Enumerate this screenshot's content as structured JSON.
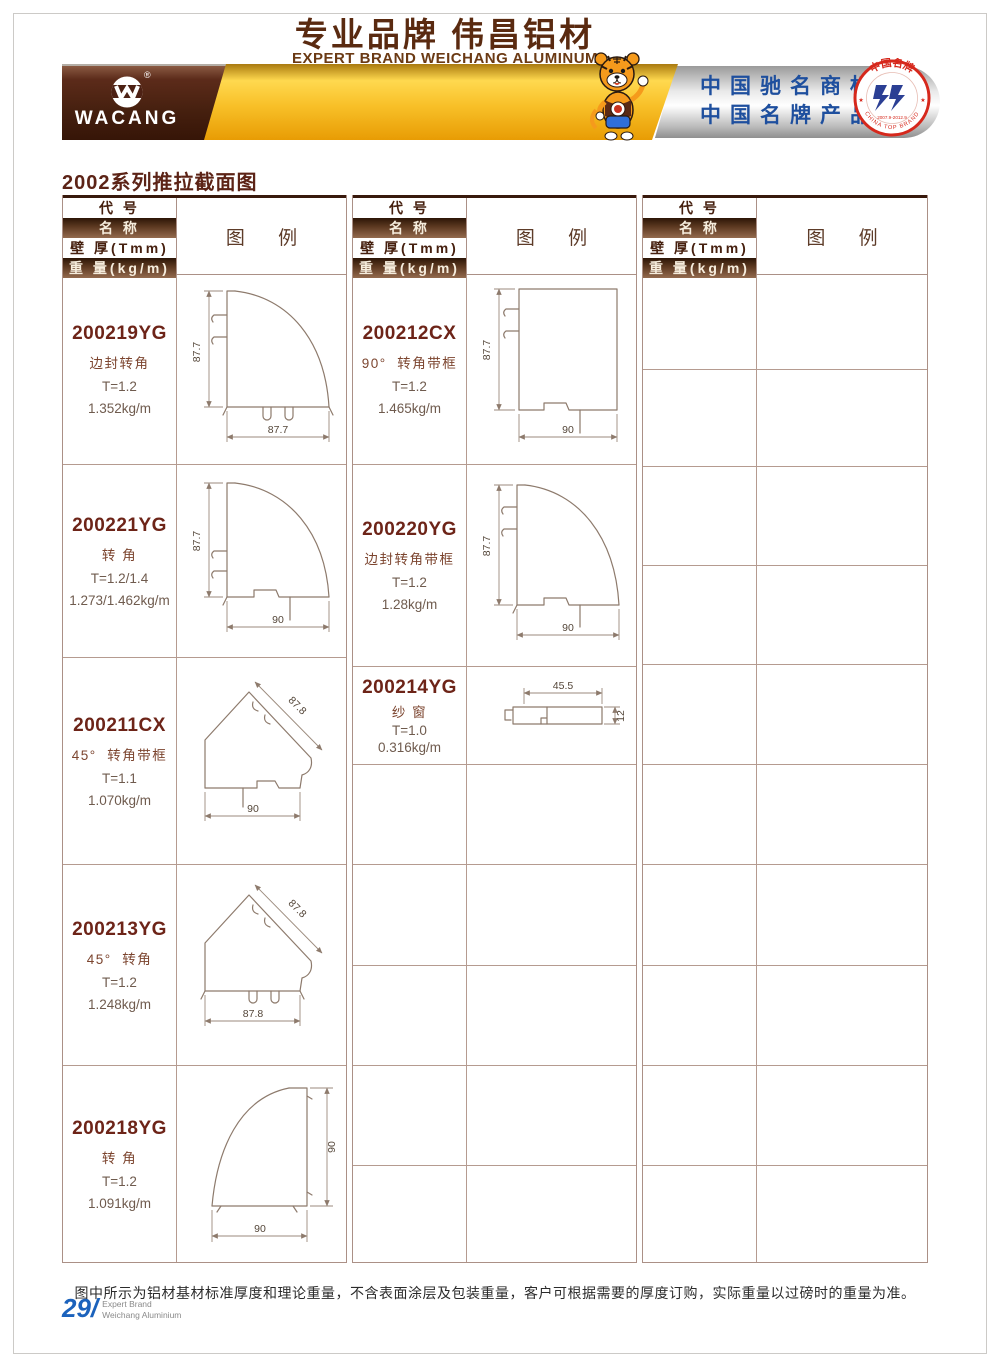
{
  "header": {
    "logo_text": "WACANG",
    "registered_mark": "®",
    "banner_cn": "专业品牌  伟昌铝材",
    "banner_en": "EXPERT BRAND WEICHANG ALUMINUM",
    "honor_line1": "中国驰名商标",
    "honor_line2": "中国名牌产品",
    "badge": {
      "arc_top": "中国名牌",
      "arc_bottom": "CHINA TOP BRAND",
      "dates": "2007.9-2012.9",
      "star": "★"
    }
  },
  "page_title": "2002系列推拉截面图",
  "table_headers": {
    "code": "代 号",
    "name": "名 称",
    "thickness": "壁 厚(Tmm)",
    "weight": "重 量(kg/m)",
    "diagram": "图 例"
  },
  "products": {
    "col1": [
      {
        "code": "200219YG",
        "name": "边封转角",
        "t": "T=1.2",
        "w": "1.352kg/m",
        "dim_v": "87.7",
        "dim_h": "87.7"
      },
      {
        "code": "200221YG",
        "name": "转 角",
        "t": "T=1.2/1.4",
        "w": "1.273/1.462kg/m",
        "dim_v": "87.7",
        "dim_h": "90"
      },
      {
        "code": "200211CX",
        "name": "45°  转角带框",
        "t": "T=1.1",
        "w": "1.070kg/m",
        "dim_d": "87.8",
        "dim_h": "90"
      },
      {
        "code": "200213YG",
        "name": "45°  转角",
        "t": "T=1.2",
        "w": "1.248kg/m",
        "dim_d": "87.8",
        "dim_h": "87.8"
      },
      {
        "code": "200218YG",
        "name": "转 角",
        "t": "T=1.2",
        "w": "1.091kg/m",
        "dim_v": "90",
        "dim_h": "90"
      }
    ],
    "col2": [
      {
        "code": "200212CX",
        "name": "90°  转角带框",
        "t": "T=1.2",
        "w": "1.465kg/m",
        "dim_v": "87.7",
        "dim_h": "90"
      },
      {
        "code": "200220YG",
        "name": "边封转角带框",
        "t": "T=1.2",
        "w": "1.28kg/m",
        "dim_v": "87.7",
        "dim_h": "90"
      },
      {
        "code": "200214YG",
        "name": "纱 窗",
        "t": "T=1.0",
        "w": "0.316kg/m",
        "dim_h": "45.5",
        "dim_v": "12"
      }
    ]
  },
  "footer": {
    "note": "图中所示为铝材基材标准厚度和理论重量，不含表面涂层及包装重量，客户可根据需要的厚度订购，实际重量以过磅时的重量为准。",
    "page_number": "29/",
    "brand_top": "Expert Brand",
    "brand_bottom": "Weichang Aluminium"
  }
}
